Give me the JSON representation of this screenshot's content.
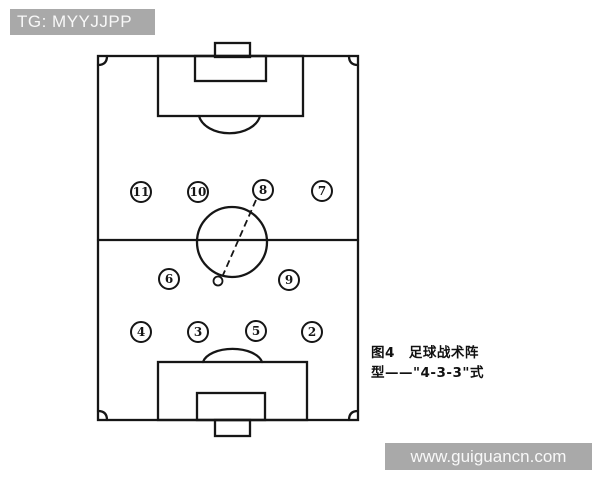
{
  "watermarks": {
    "top": "TG: MYYJJPP",
    "bottom": "www.guiguancn.com",
    "bg_color": "#a9a9a9",
    "text_color": "#f8f8f8"
  },
  "caption": {
    "figure_label": "图4",
    "line1": "图4　足球战术阵",
    "line2": "型——\"4-3-3\"式",
    "full_text": "图4 足球战术阵型——\"4-3-3\"式"
  },
  "diagram": {
    "type": "football-formation",
    "formation_name": "4-3-3",
    "line_color": "#161616",
    "players": [
      {
        "number": "11",
        "x": 141,
        "y": 192
      },
      {
        "number": "10",
        "x": 198,
        "y": 192
      },
      {
        "number": "8",
        "x": 263,
        "y": 190
      },
      {
        "number": "7",
        "x": 322,
        "y": 191
      },
      {
        "number": "6",
        "x": 169,
        "y": 279
      },
      {
        "number": "9",
        "x": 289,
        "y": 280
      },
      {
        "number": "4",
        "x": 141,
        "y": 332
      },
      {
        "number": "3",
        "x": 198,
        "y": 332
      },
      {
        "number": "5",
        "x": 256,
        "y": 331
      },
      {
        "number": "2",
        "x": 312,
        "y": 332
      }
    ],
    "ball": {
      "x": 218,
      "y": 281
    },
    "pass_line": {
      "from_player": "8",
      "to": "ball",
      "style": "dashed"
    }
  }
}
